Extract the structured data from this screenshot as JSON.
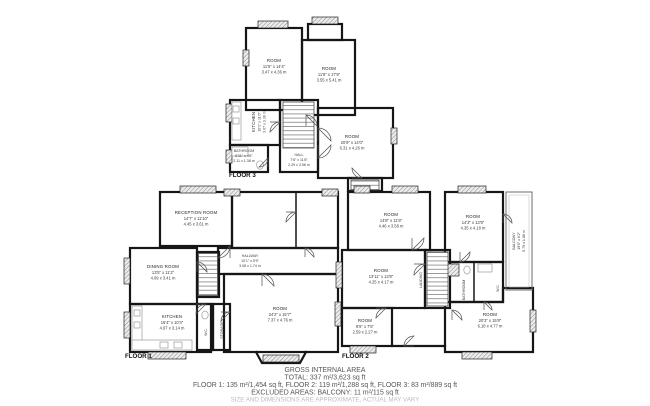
{
  "colors": {
    "wall": "#161616",
    "window_hatch": "#8a8a8a",
    "label_text": "#2b2b2b",
    "footer_text": "#565656",
    "footer_muted": "#bcbcbc"
  },
  "floors": {
    "floor1": {
      "label": "FLOOR 1",
      "rooms": [
        {
          "name": "RECEPTION ROOM",
          "imperial": "14'7\" x 11'10\"",
          "metric": "4.45 x 3.61 m"
        },
        {
          "name": "DINING ROOM",
          "imperial": "13'5\" x 11'2\"",
          "metric": "4.09 x 3.41 m"
        },
        {
          "name": "KITCHEN",
          "imperial": "16'4\" x 10'4\"",
          "metric": "4.97 x 3.14 m"
        },
        {
          "name": "HALLWAY",
          "imperial": "10'1\" x 5'9\"",
          "metric": "3.08 x 1.74 m"
        },
        {
          "name": "ROOM",
          "imperial": "24'2\" x 15'7\"",
          "metric": "7.37 x 4.76 m"
        },
        {
          "name": "W.C."
        },
        {
          "name": "STORAGE"
        }
      ]
    },
    "floor2": {
      "label": "FLOOR 2",
      "rooms": [
        {
          "name": "ROOM",
          "imperial": "14'8\" x 11'9\"",
          "metric": "4.46 x 3.58 m"
        },
        {
          "name": "ROOM",
          "imperial": "14'3\" x 13'9\"",
          "metric": "4.35 x 4.18 m"
        },
        {
          "name": "ROOM",
          "imperial": "13'11\" x 13'8\"",
          "metric": "4.25 x 4.17 m"
        },
        {
          "name": "ROOM",
          "imperial": "8'6\" x 7'5\"",
          "metric": "2.59 x 2.27 m"
        },
        {
          "name": "ROOM",
          "imperial": "20'3\" x 15'8\"",
          "metric": "6.18 x 4.77 m"
        },
        {
          "name": "LANDING"
        },
        {
          "name": "BALCONY",
          "imperial": "19'0\" x 6'2\"",
          "metric": "5.79 x 1.88 m"
        },
        {
          "name": "BATHROOM"
        },
        {
          "name": "W.C."
        }
      ]
    },
    "floor3": {
      "label": "FLOOR 3",
      "rooms": [
        {
          "name": "ROOM",
          "imperial": "11'5\" x 14'4\"",
          "metric": "3.47 x 4.36 m"
        },
        {
          "name": "ROOM",
          "imperial": "11'8\" x 17'9\"",
          "metric": "3.55 x 5.41 m"
        },
        {
          "name": "KITCHEN",
          "imperial": "10'1\" x 11'0\"",
          "metric": "3.07 x 3.36 m"
        },
        {
          "name": "BATHROOM",
          "imperial": "6'11\" x 4'6\"",
          "metric": "2.11 x 1.38 m"
        },
        {
          "name": "HALL",
          "imperial": "7'6\" x 11'8\"",
          "metric": "2.29 x 3.56 m"
        },
        {
          "name": "ROOM",
          "imperial": "20'9\" x 14'0\"",
          "metric": "6.31 x 4.26 m"
        }
      ]
    }
  },
  "footer": {
    "line1": "GROSS INTERNAL AREA",
    "line2": "TOTAL: 337 m²/3,623 sq ft",
    "line3": "FLOOR 1: 135 m²/1,454 sq ft, FLOOR 2: 119 m²/1,288 sq ft, FLOOR 3: 83 m²/889 sq ft",
    "line4": "EXCLUDED AREAS: BALCONY: 11 m²/115 sq ft",
    "line5": "SIZE AND DIMENSIONS ARE APPROXIMATE, ACTUAL MAY VARY"
  }
}
